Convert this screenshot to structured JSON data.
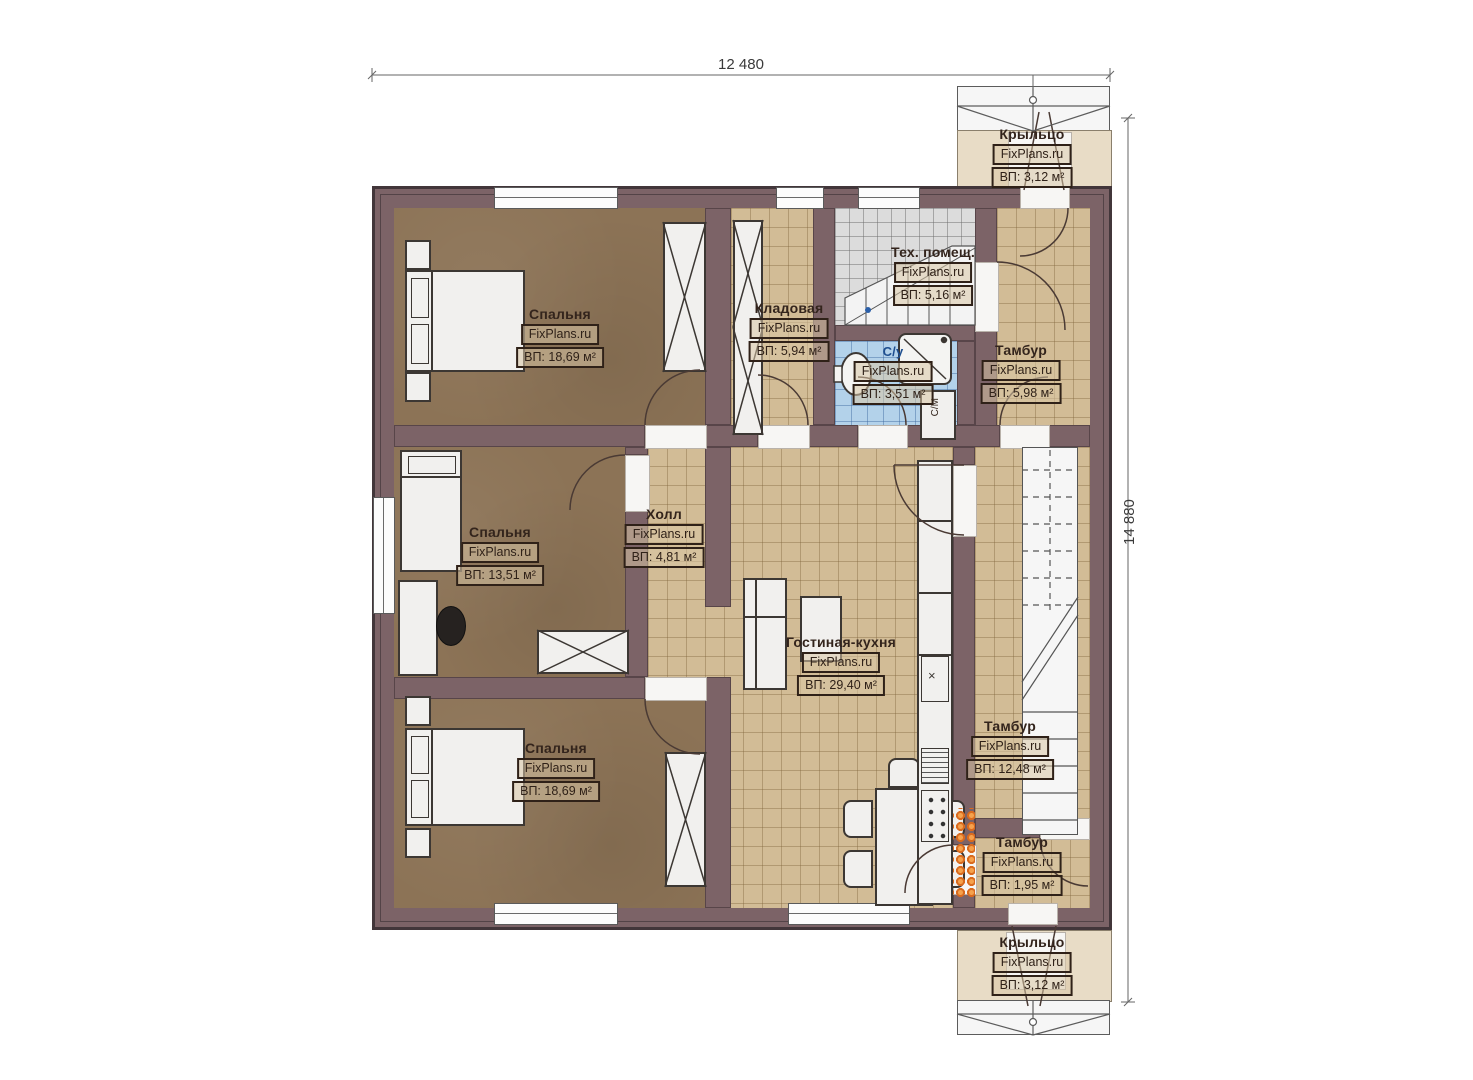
{
  "dimensions": {
    "width_label": "12 480",
    "height_label": "14 880"
  },
  "rooms": {
    "bedroom1": {
      "name": "Спальня",
      "watermark": "FixPlans.ru",
      "area": "ВП: 18,69 м²"
    },
    "bedroom2": {
      "name": "Спальня",
      "watermark": "FixPlans.ru",
      "area": "ВП: 13,51 м²"
    },
    "bedroom3": {
      "name": "Спальня",
      "watermark": "FixPlans.ru",
      "area": "ВП: 18,69 м²"
    },
    "hall": {
      "name": "Холл",
      "watermark": "FixPlans.ru",
      "area": "ВП: 4,81 м²"
    },
    "storage": {
      "name": "Кладовая",
      "watermark": "FixPlans.ru",
      "area": "ВП: 5,94 м²"
    },
    "tech_room": {
      "name": "Тех. помещ.",
      "watermark": "FixPlans.ru",
      "area": "ВП: 5,16 м²"
    },
    "bathroom": {
      "name": "С/у",
      "watermark": "FixPlans.ru",
      "area": "ВП: 3,51 м²"
    },
    "tambour_top": {
      "name": "Тамбур",
      "watermark": "FixPlans.ru",
      "area": "ВП: 5,98 м²"
    },
    "tambour_right": {
      "name": "Тамбур",
      "watermark": "FixPlans.ru",
      "area": "ВП: 12,48 м²"
    },
    "tambour_bottom": {
      "name": "Тамбур",
      "watermark": "FixPlans.ru",
      "area": "ВП: 1,95 м²"
    },
    "living_kitchen": {
      "name": "Гостиная-кухня",
      "watermark": "FixPlans.ru",
      "area": "ВП: 29,40 м²"
    },
    "porch_top": {
      "name": "Крыльцо",
      "watermark": "FixPlans.ru",
      "area": "ВП: 3,12 м²"
    },
    "porch_bottom": {
      "name": "Крыльцо",
      "watermark": "FixPlans.ru",
      "area": "ВП: 3,12 м²"
    }
  },
  "appliances": {
    "washing_machine_label": "С/М",
    "kitchen_sink_symbol": "×"
  },
  "colors": {
    "wall": "#7c6367",
    "bedroom_floor": "#8c7356",
    "tile_floor": "#d2bc96",
    "bath_tile": "#b3d2ea",
    "tech_tile": "#dcdcdc",
    "porch_floor": "#e8dcc6",
    "accent_orange": "#dd6f22"
  }
}
